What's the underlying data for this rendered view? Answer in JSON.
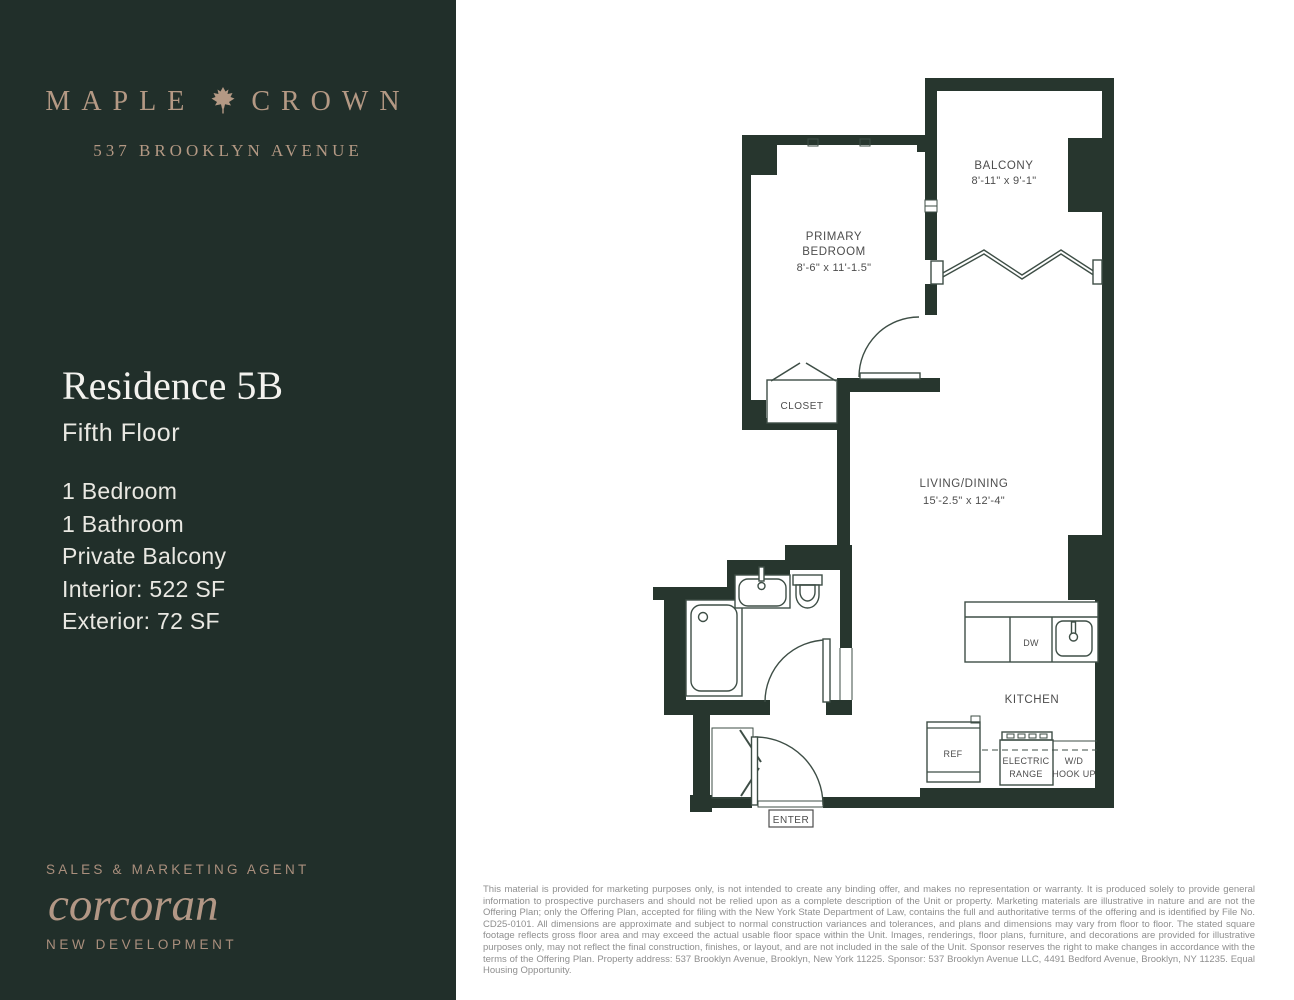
{
  "brand": {
    "name_left": "MAPLE",
    "name_right": "CROWN",
    "icon": "maple-leaf",
    "address": "537 BROOKLYN AVENUE"
  },
  "residence": {
    "title": "Residence 5B",
    "floor": "Fifth Floor",
    "features": [
      "1 Bedroom",
      "1 Bathroom",
      "Private Balcony",
      "Interior: 522 SF",
      "Exterior: 72 SF"
    ]
  },
  "agent": {
    "label": "SALES & MARKETING AGENT",
    "logo": "corcoran",
    "sub": "NEW DEVELOPMENT"
  },
  "floorplan": {
    "rooms": {
      "balcony": {
        "name": "BALCONY",
        "dims": "8'-11\" x 9'-1\""
      },
      "bedroom": {
        "name_line1": "PRIMARY",
        "name_line2": "BEDROOM",
        "dims": "8'-6\" x 11'-1.5\""
      },
      "living": {
        "name": "LIVING/DINING",
        "dims": "15'-2.5\" x 12'-4\""
      },
      "kitchen": {
        "name": "KITCHEN"
      },
      "closet": {
        "name": "CLOSET"
      }
    },
    "fixtures": {
      "dw": "DW",
      "ref": "REF",
      "range_line1": "ELECTRIC",
      "range_line2": "RANGE",
      "wd_line1": "W/D",
      "wd_line2": "HOOK UP",
      "enter": "ENTER"
    }
  },
  "disclaimer": "This material is provided for marketing purposes only, is not intended to create any binding offer, and makes no representation or warranty. It is produced solely to provide general information to prospective purchasers and should not be relied upon as a complete description of the Unit or property. Marketing materials are illustrative in nature and are not the Offering Plan; only the Offering Plan, accepted for filing with the New York State Department of Law, contains the full and authoritative terms of the offering and is identified by File No. CD25-0101. All dimensions are approximate and subject to normal construction variances and tolerances, and plans and dimensions may vary from floor to floor. The stated square footage reflects gross floor area and may exceed the actual usable floor space within the Unit. Images, renderings, floor plans, furniture, and decorations are provided for illustrative purposes only, may not reflect the final construction, finishes, or layout, and are not included in the sale of the Unit. Sponsor reserves the right to make changes in accordance with the terms of the Offering Plan. Property address: 537 Brooklyn Avenue, Brooklyn, New York 11225. Sponsor: 537 Brooklyn Avenue LLC, 4491 Bedford Avenue, Brooklyn, NY 11235. Equal Housing Opportunity.",
  "colors": {
    "sidebar_bg": "#212f2a",
    "accent_tan": "#b49984",
    "wall": "#27362e",
    "heading_text": "#f3f2ee",
    "body_text": "#e9e8e2",
    "plan_line": "#3e4e46",
    "plan_label": "#4d4d4d",
    "disclaimer_text": "#8f8f8f"
  }
}
